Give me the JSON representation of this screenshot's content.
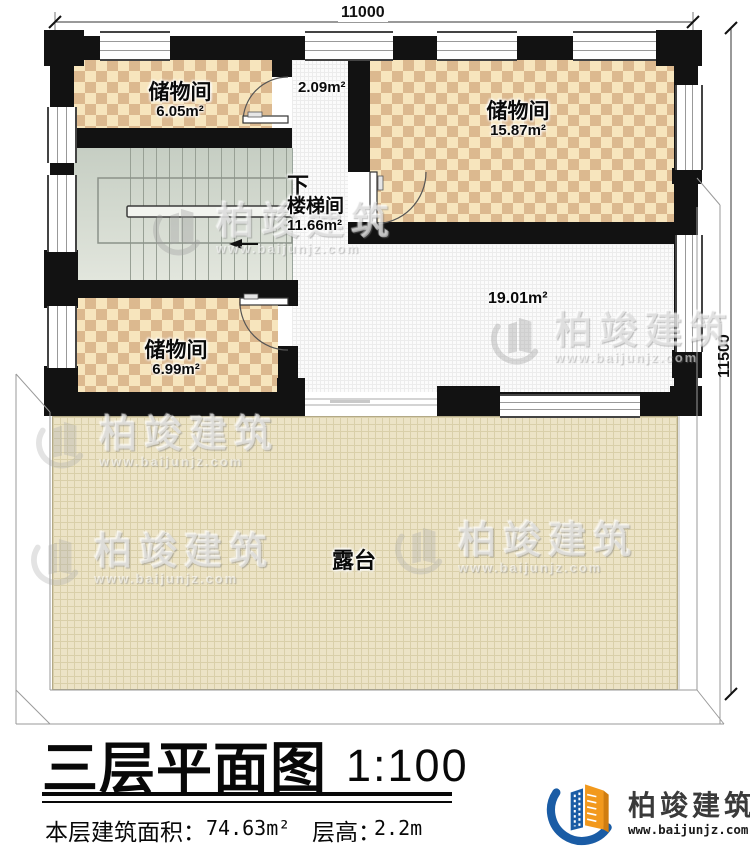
{
  "plan": {
    "dimensions": {
      "width": "11000",
      "height": "11500"
    },
    "rooms": {
      "storage_a": {
        "name": "储物间",
        "area": "6.05m²"
      },
      "hall": {
        "area": "2.09m²"
      },
      "storage_b": {
        "name": "储物间",
        "area": "15.87m²"
      },
      "stair": {
        "dir": "下",
        "name": "楼梯间",
        "area": "11.66m²"
      },
      "storage_c": {
        "name": "储物间",
        "area": "6.99m²"
      },
      "open": {
        "area": "19.01m²"
      },
      "terrace": {
        "name": "露台"
      }
    }
  },
  "title": {
    "text": "三层平面图",
    "scale": "1:100",
    "area_label": "本层建筑面积：",
    "area_value": "74.63m²",
    "height_label": "层高：",
    "height_value": "2.2m"
  },
  "brand": {
    "name": "柏竣建筑",
    "url": "www.baijunjz.com"
  },
  "watermark": {
    "name": "柏竣建筑",
    "url": "www.baijunjz.com"
  },
  "colors": {
    "wall": "#121212",
    "checker_light": "#f7e5bd",
    "checker_dark": "#dcb98f",
    "stairs": "#ccd3c8",
    "terrace": "#ece3c6",
    "brand_blue": "#1a5ca5",
    "brand_orange": "#f2991d"
  }
}
